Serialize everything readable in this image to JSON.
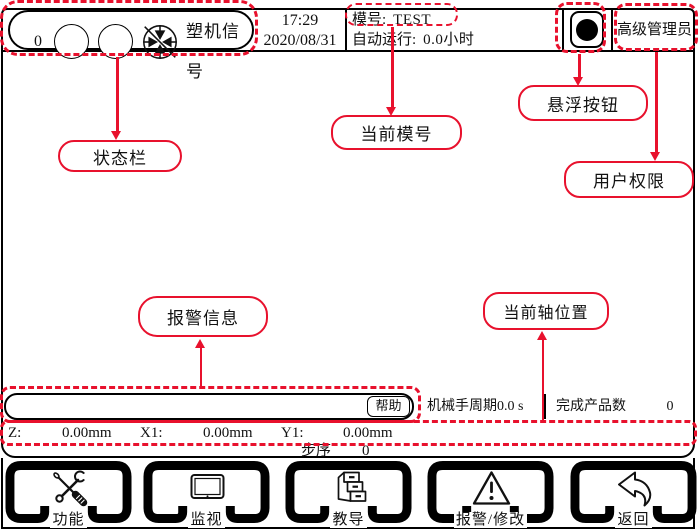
{
  "colors": {
    "annotation_red": "#e8112d",
    "ui_black": "#111111"
  },
  "top_bar": {
    "counter": "0",
    "signal_label": "塑机信号",
    "status_indicator_icon": "mold-signal-icon",
    "time": "17:29",
    "date": "2020/08/31",
    "mold_label": "模号:",
    "mold_value": "TEST",
    "autorun_label": "自动运行:",
    "autorun_value": "0.0小时",
    "floating_button_icon": "record-circle-icon",
    "user_role": "高级管理员"
  },
  "alarm_bar": {
    "message": "",
    "help_button": "帮助"
  },
  "stats": {
    "cycle_label": "机械手周期",
    "cycle_value": "0.0 s",
    "products_label": "完成产品数",
    "products_value": "0"
  },
  "axis_bar": {
    "axes": [
      {
        "label": "Z:",
        "value": "0.00mm"
      },
      {
        "label": "X1:",
        "value": "0.00mm"
      },
      {
        "label": "Y1:",
        "value": "0.00mm"
      }
    ],
    "step_label": "步序",
    "step_value": "0"
  },
  "toolbar": {
    "buttons": [
      {
        "label": "功能",
        "icon": "tools-icon"
      },
      {
        "label": "监视",
        "icon": "monitor-icon"
      },
      {
        "label": "教导",
        "icon": "cabinet-icon"
      },
      {
        "label": "报警/修改",
        "icon": "warning-icon"
      },
      {
        "label": "返回",
        "icon": "back-arrow-icon"
      }
    ]
  },
  "annotations": {
    "status_bar": "状态栏",
    "current_mold": "当前模号",
    "floating_button": "悬浮按钮",
    "user_permission": "用户权限",
    "alarm_info": "报警信息",
    "axis_position": "当前轴位置"
  }
}
